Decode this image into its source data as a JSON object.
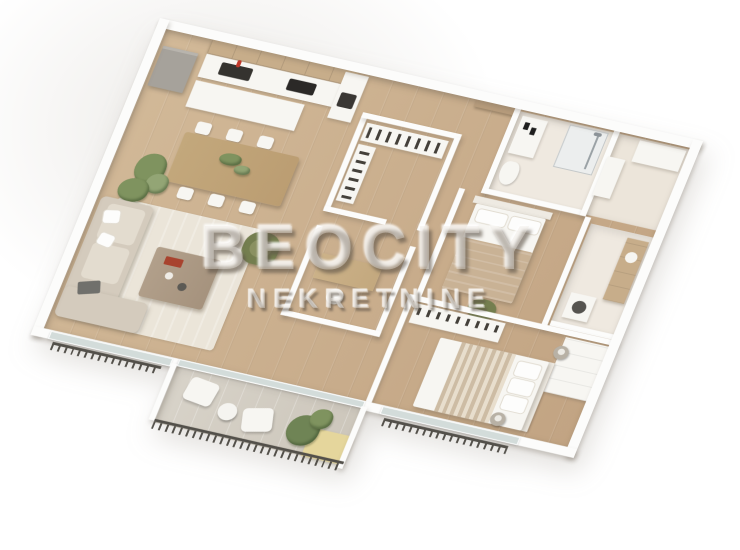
{
  "watermark": {
    "title": "BEOCITY",
    "subtitle": "NEKRETNINE"
  },
  "scene": {
    "description": "3D axonometric rendering of an apartment floor plan, white walls, wooden floors",
    "palette": {
      "background": "#ffffff",
      "walls": "#fcfcfb",
      "wood_floor": "#d2b998",
      "wood_floor_dark": "#c2a483",
      "bathroom_tile": "#efe9e0",
      "rug": "#ebe5d9",
      "sofa": "#d4cbbd",
      "armchair_green": "#747e4f",
      "dining_table_wood": "#bb9d72",
      "coffee_table_wood": "#a5927d",
      "terrace_floor": "#d8d3c9",
      "yellow_panel": "#e5d69c",
      "railing": "#53504a",
      "fridge_gray": "#a6a29b",
      "blanket_beige": "#c9b295",
      "red_faucet": "#c0392b",
      "watermark_text": "rgba(235,231,224,0.42)"
    }
  },
  "floorplan": {
    "type": "apartment-3d-render",
    "rooms": [
      {
        "name": "kitchen",
        "items": [
          "upper-cabinets",
          "counter",
          "sink",
          "red-faucet",
          "cooktop",
          "oven-cabinet",
          "fridge",
          "island-counter"
        ]
      },
      {
        "name": "dining-area",
        "items": [
          "dining-table",
          "six-white-chairs",
          "table-plant",
          "floor-plant"
        ]
      },
      {
        "name": "living-room",
        "items": [
          "corner-sofa",
          "laptop",
          "coffee-table",
          "red-book",
          "green-armchair",
          "area-rug",
          "plant"
        ]
      },
      {
        "name": "terrace",
        "items": [
          "railing",
          "two-lounge-chairs",
          "round-table",
          "planter",
          "yellow-floor-panel",
          "glass-doors"
        ]
      },
      {
        "name": "walk-in-closet",
        "items": [
          "wardrobe-hanging-clothes",
          "side-wardrobe"
        ]
      },
      {
        "name": "office-nook",
        "items": [
          "desk",
          "white-chair"
        ]
      },
      {
        "name": "entrance",
        "items": [
          "wooden-door"
        ]
      },
      {
        "name": "bathroom",
        "items": [
          "washbasin",
          "shower",
          "toilet"
        ]
      },
      {
        "name": "hallway",
        "items": [
          "tall-white-cabinet",
          "white-cabinet"
        ]
      },
      {
        "name": "laundry-bathroom",
        "items": [
          "wooden-vanity",
          "washing-machine"
        ]
      },
      {
        "name": "bedroom-1",
        "items": [
          "double-bed",
          "pillows",
          "beige-blanket",
          "green-pouf"
        ]
      },
      {
        "name": "bedroom-2",
        "items": [
          "double-bed-striped-blanket",
          "pillows",
          "shoe-wardrobe",
          "white-wardrobe",
          "two-nightstands-with-lamps",
          "window-with-railing"
        ]
      }
    ]
  }
}
